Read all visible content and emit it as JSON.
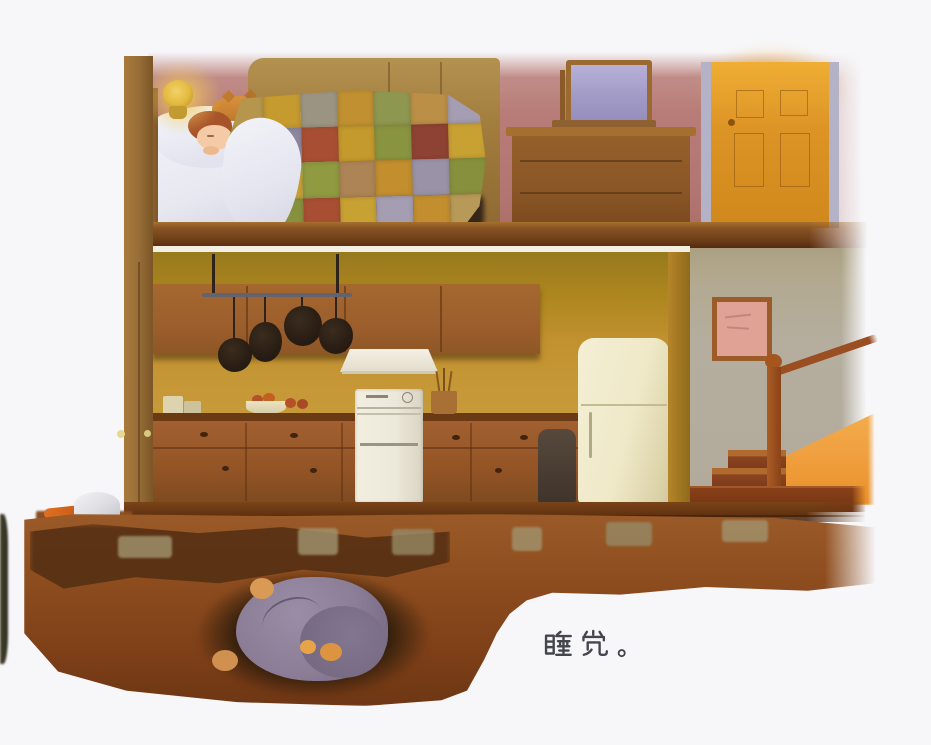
{
  "caption": {
    "text": "睡觉。"
  },
  "palette": {
    "paper": "#f7f7f9",
    "ink": "#45454d",
    "mauve": "#b87d78",
    "mauve-deep": "#a96b66",
    "wood-beam": "#9a7038",
    "bed-frame": "#a9853f",
    "floor": "#7a4418",
    "ceiling": "#f2efe2",
    "kitchen-wall": "#c29230",
    "kitchen-wall-top": "#97791e",
    "cabinet": "#9c5e2c",
    "counter": "#6a3a14",
    "appliance-white": "#ece8da",
    "fridge-cream": "#efe9c8",
    "door-orange": "#dd9426",
    "door-jamb": "#b4b2c6",
    "hall-wall": "#b5ae9f",
    "hall-khaki": "#aba082",
    "stair-wood": "#9a4e22",
    "sun-orange": "#f0a040",
    "dirt": "#8f4e1f",
    "dirt-dark": "#4e2c12",
    "burrow": "#2e1d0c",
    "mole": "#8b7d96",
    "mole-dark": "#776b84",
    "paw-orange": "#d89a55",
    "lamp-gold": "#e3b93f",
    "pan-iron": "#261b12",
    "stone": "#a1946e",
    "picture-pink": "#e0a295",
    "quilt-shadow": "#2e2118"
  },
  "quilt": {
    "patches": [
      "#b5964c",
      "#c59a2e",
      "#9b9483",
      "#c09031",
      "#8e9750",
      "#bb8f45",
      "#a59db1",
      "#8f9a41",
      "#8c87a0",
      "#a84f33",
      "#c49a2d",
      "#899440",
      "#8e4233",
      "#c8a133",
      "#8e4233",
      "#c8a133",
      "#8f9a41",
      "#ad8455",
      "#c28e2e",
      "#9a93a8",
      "#87913d",
      "#b3884a",
      "#87913d",
      "#a84f33",
      "#c8a133",
      "#a59db1",
      "#c28e2e",
      "#b89a58"
    ]
  }
}
